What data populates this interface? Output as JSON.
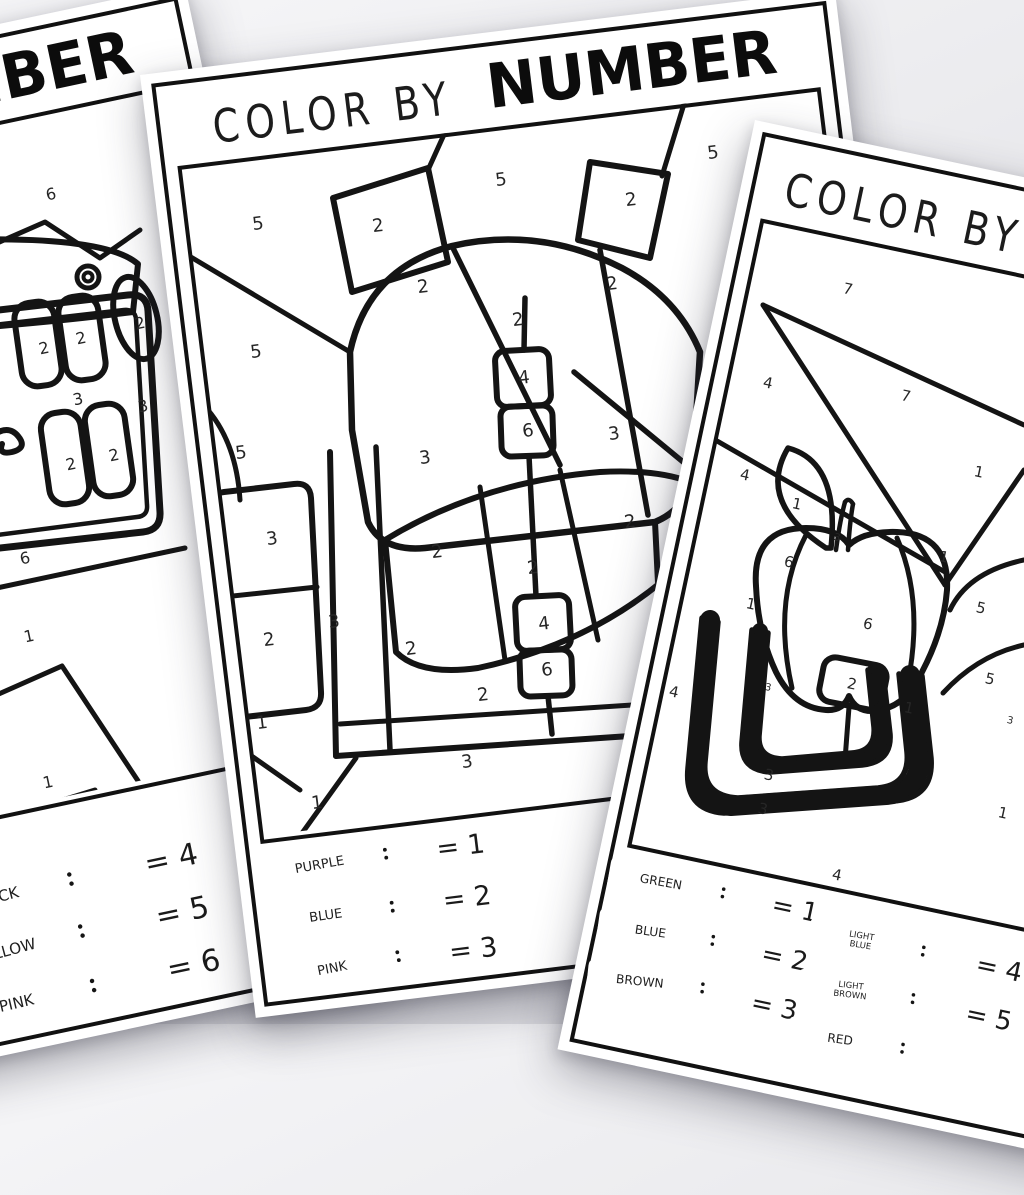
{
  "background_color": "#e8e8ec",
  "ink_color": "#141414",
  "paper_color": "#ffffff",
  "pages": [
    {
      "name": "left-worksheet",
      "subject": "pencil-case",
      "title_script": "COLOR BY",
      "title_bold": "NUMBER",
      "numbers": [
        {
          "n": "6",
          "x": 51,
          "y": 194
        },
        {
          "n": "2",
          "x": 44,
          "y": 348
        },
        {
          "n": "2",
          "x": 81,
          "y": 338
        },
        {
          "n": "2",
          "x": 140,
          "y": 323
        },
        {
          "n": "3",
          "x": 78,
          "y": 399
        },
        {
          "n": "3",
          "x": 143,
          "y": 406
        },
        {
          "n": "2",
          "x": 71,
          "y": 464
        },
        {
          "n": "2",
          "x": 114,
          "y": 455
        },
        {
          "n": "6",
          "x": 25,
          "y": 558
        },
        {
          "n": "1",
          "x": 29,
          "y": 636
        },
        {
          "n": "1",
          "x": 48,
          "y": 782
        }
      ],
      "legend_columns": [
        {
          "items": [
            {
              "label": "BLACK",
              "value": "= 4"
            },
            {
              "label": "YELLOW",
              "value": "= 5"
            },
            {
              "label": "PINK",
              "value": "= 6"
            }
          ]
        }
      ]
    },
    {
      "name": "middle-worksheet",
      "subject": "backpack",
      "title_script": "COLOR BY",
      "title_bold": "NUMBER",
      "numbers": [
        {
          "n": "5",
          "x": 258,
          "y": 224
        },
        {
          "n": "2",
          "x": 378,
          "y": 226
        },
        {
          "n": "5",
          "x": 501,
          "y": 180
        },
        {
          "n": "5",
          "x": 713,
          "y": 153
        },
        {
          "n": "2",
          "x": 631,
          "y": 200
        },
        {
          "n": "2",
          "x": 423,
          "y": 287
        },
        {
          "n": "2",
          "x": 612,
          "y": 284
        },
        {
          "n": "2",
          "x": 518,
          "y": 320
        },
        {
          "n": "5",
          "x": 256,
          "y": 352
        },
        {
          "n": "4",
          "x": 524,
          "y": 378
        },
        {
          "n": "3",
          "x": 614,
          "y": 434
        },
        {
          "n": "6",
          "x": 528,
          "y": 431
        },
        {
          "n": "5",
          "x": 241,
          "y": 453
        },
        {
          "n": "3",
          "x": 425,
          "y": 458
        },
        {
          "n": "2",
          "x": 630,
          "y": 522
        },
        {
          "n": "3",
          "x": 272,
          "y": 539
        },
        {
          "n": "2",
          "x": 437,
          "y": 552
        },
        {
          "n": "2",
          "x": 533,
          "y": 568
        },
        {
          "n": "3",
          "x": 334,
          "y": 622
        },
        {
          "n": "4",
          "x": 544,
          "y": 624
        },
        {
          "n": "2",
          "x": 269,
          "y": 640
        },
        {
          "n": "2",
          "x": 411,
          "y": 649
        },
        {
          "n": "6",
          "x": 547,
          "y": 670
        },
        {
          "n": "2",
          "x": 483,
          "y": 695
        },
        {
          "n": "1",
          "x": 262,
          "y": 723
        },
        {
          "n": "3",
          "x": 467,
          "y": 762
        },
        {
          "n": "1",
          "x": 317,
          "y": 803
        }
      ],
      "legend_columns": [
        {
          "items": [
            {
              "label": "PURPLE",
              "value": "= 1"
            },
            {
              "label": "BLUE",
              "value": "= 2"
            },
            {
              "label": "PINK",
              "value": "= 3"
            }
          ]
        }
      ]
    },
    {
      "name": "right-worksheet",
      "subject": "apple",
      "title_script": "COLOR BY",
      "title_bold": "NUMBER",
      "numbers": [
        {
          "n": "7",
          "x": 848,
          "y": 289
        },
        {
          "n": "4",
          "x": 768,
          "y": 383
        },
        {
          "n": "7",
          "x": 906,
          "y": 396
        },
        {
          "n": "4",
          "x": 745,
          "y": 475
        },
        {
          "n": "1",
          "x": 979,
          "y": 472
        },
        {
          "n": "1",
          "x": 797,
          "y": 504
        },
        {
          "n": "3",
          "x": 837,
          "y": 538,
          "small": true
        },
        {
          "n": "1",
          "x": 944,
          "y": 557
        },
        {
          "n": "6",
          "x": 789,
          "y": 562
        },
        {
          "n": "1",
          "x": 751,
          "y": 604
        },
        {
          "n": "5",
          "x": 981,
          "y": 608
        },
        {
          "n": "6",
          "x": 868,
          "y": 624
        },
        {
          "n": "5",
          "x": 990,
          "y": 679
        },
        {
          "n": "2",
          "x": 852,
          "y": 684
        },
        {
          "n": "4",
          "x": 674,
          "y": 692
        },
        {
          "n": "3",
          "x": 768,
          "y": 688,
          "small": true
        },
        {
          "n": "1",
          "x": 909,
          "y": 708
        },
        {
          "n": "3",
          "x": 1010,
          "y": 721,
          "small": true
        },
        {
          "n": "3",
          "x": 769,
          "y": 775
        },
        {
          "n": "3",
          "x": 763,
          "y": 809
        },
        {
          "n": "1",
          "x": 1003,
          "y": 813
        },
        {
          "n": "4",
          "x": 837,
          "y": 875
        }
      ],
      "legend_columns": [
        {
          "items": [
            {
              "label": "GREEN",
              "value": "= 1"
            },
            {
              "label": "BLUE",
              "value": "= 2"
            },
            {
              "label": "BROWN",
              "value": "= 3"
            }
          ]
        },
        {
          "items": [
            {
              "label": "LIGHT BLUE",
              "value": "= 4"
            },
            {
              "label": "LIGHT BROWN",
              "value": "= 5"
            },
            {
              "label": "RED",
              "value": ""
            }
          ]
        }
      ]
    }
  ]
}
